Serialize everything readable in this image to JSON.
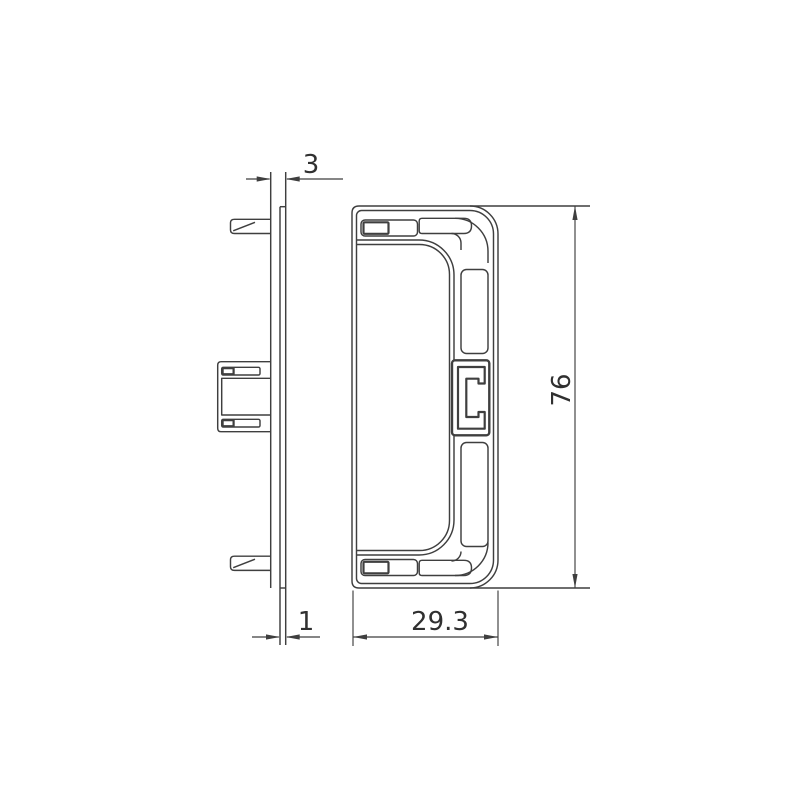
{
  "document": {
    "type": "technical-drawing",
    "description": "End cap for trunking - two orthographic views (side profile with mounting pins and clip bracket, front C-profile face) with linear dimensions in millimetres",
    "views": {
      "side_view": "side profile with top pin, middle clip bracket, bottom pin",
      "front_view": "C-shaped face with latch slots, corner channels and centre clip detail"
    }
  },
  "dimensions": {
    "top_depth_label": "3",
    "bottom_thickness_label": "1",
    "width_label": "29.3",
    "height_label": "76"
  },
  "colors": {
    "line_color": "#3f3f3f",
    "text_color": "#303030",
    "background": "#ffffff"
  }
}
